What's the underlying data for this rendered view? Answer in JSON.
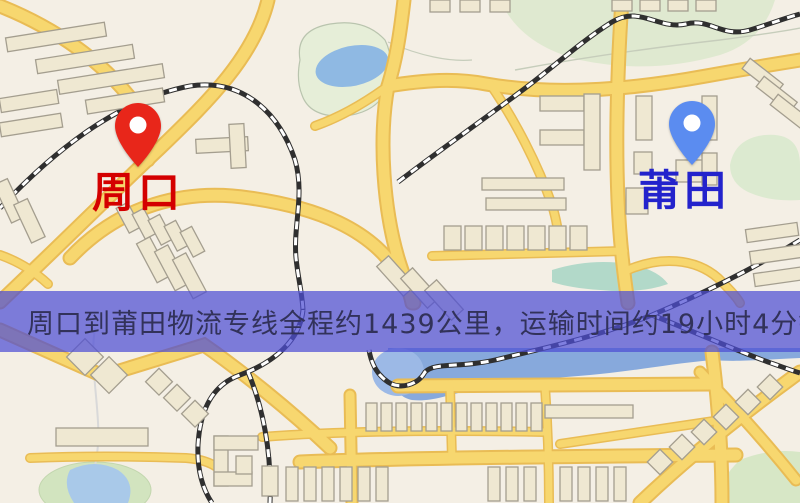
{
  "map": {
    "markers": {
      "origin": {
        "label": "周口",
        "label_color": "#d40000",
        "pin_color": "#e8261a",
        "icon": "map-pin-icon"
      },
      "destination": {
        "label": "莆田",
        "label_color": "#2323cc",
        "pin_color": "#5b8cf0",
        "icon": "map-pin-icon"
      }
    },
    "palette": {
      "background": "#f4efe5",
      "road_fill": "#f7d76f",
      "road_casing": "#e9bc55",
      "railway_dark": "#2f2f2f",
      "railway_light": "#ffffff",
      "building_fill": "#efe8d2",
      "building_stroke": "#a49e8f",
      "green_area": "#dfe9d0",
      "water": "#8fb9e3",
      "river": "#87a9dc"
    }
  },
  "banner": {
    "text": "周口到莆田物流专线全程约1439公里，运输时间约19小时4分钟.",
    "background_color": "#6a6ad8",
    "text_color": "#32325a"
  }
}
